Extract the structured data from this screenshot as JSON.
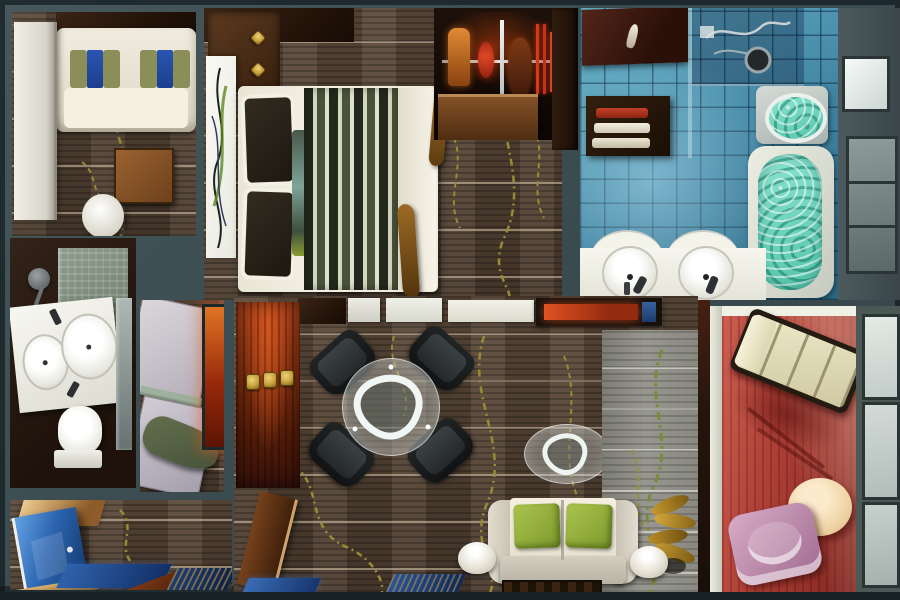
{
  "scene": {
    "type": "3d-floorplan-render",
    "view": "top-down",
    "subject": "hotel suite floor plan with bedroom, bathrooms, living room and terrace"
  },
  "palette": {
    "wall": "#3c4d51",
    "wall-dark": "#25312f",
    "carpet": "#4c3c2f",
    "carpet-hi": "#5d4b3b",
    "vine": "#988b34",
    "tile": "#3f82a0",
    "tile-hi": "#68b2c9",
    "water": "#55c4ac",
    "water-hi": "#8ae4cf",
    "balcony-red": "#b24339",
    "accent-red": "#c23d1d",
    "accent-gold": "#c7a23c",
    "sofa-cream": "#efeadd",
    "cushion-green": "#8fae3a",
    "pillow-olive": "#8a8f5a",
    "pillow-blue": "#1c3f8f",
    "door-blue": "#2f6db5",
    "wood": "#7a4e28",
    "wardrobe-red": "#8a3415",
    "chaise-cream": "#e2dcbc",
    "chair-pink": "#c793b5",
    "pouf-cream": "#f3e0bd"
  },
  "rooms": [
    {
      "id": "lounge",
      "name": "sitting-room",
      "furniture": [
        "cream sofa with olive and blue pillows",
        "wood coffee table",
        "white round stool",
        "white wardrobe panel"
      ]
    },
    {
      "id": "bedroom",
      "name": "bedroom",
      "furniture": [
        "double bed with striped runner",
        "dark pillows with teal accent pillow",
        "abstract wall artwork",
        "nightstand with brass knobs",
        "driftwood sculptures"
      ]
    },
    {
      "id": "closet",
      "name": "wardrobe-closet",
      "furniture": [
        "backlit hanging clothes",
        "chrome rail",
        "wood dresser"
      ]
    },
    {
      "id": "bathroom",
      "name": "main-bathroom",
      "furniture": [
        "walk-in shower",
        "towel shelf with red and cream towels",
        "jacuzzi",
        "soaking tub with water",
        "double sink vanity"
      ]
    },
    {
      "id": "small-bathroom",
      "name": "guest-bathroom",
      "furniture": [
        "corner shower",
        "double basin vanity",
        "toilet",
        "mirror strip"
      ]
    },
    {
      "id": "dressing",
      "name": "dressing-area",
      "furniture": [
        "light wardrobe cabinets",
        "glass shelf",
        "green garment bag",
        "backlit red panel"
      ]
    },
    {
      "id": "living",
      "name": "living-room",
      "furniture": [
        "round glass dining table",
        "four black armchairs",
        "oval glass coffee table",
        "cream sofa with green cushions",
        "two dome floor lamps",
        "red wardrobe with brass handles",
        "media console with red glow",
        "gold floor plant",
        "gray slat feature panel"
      ]
    },
    {
      "id": "entry",
      "name": "entry-hall",
      "furniture": [
        "blue entry door",
        "gold sill",
        "blue floor mats"
      ]
    },
    {
      "id": "balcony",
      "name": "terrace-lounge",
      "furniture": [
        "chaise longue",
        "round cream pouf",
        "pink lounge chair",
        "window wall"
      ]
    }
  ]
}
